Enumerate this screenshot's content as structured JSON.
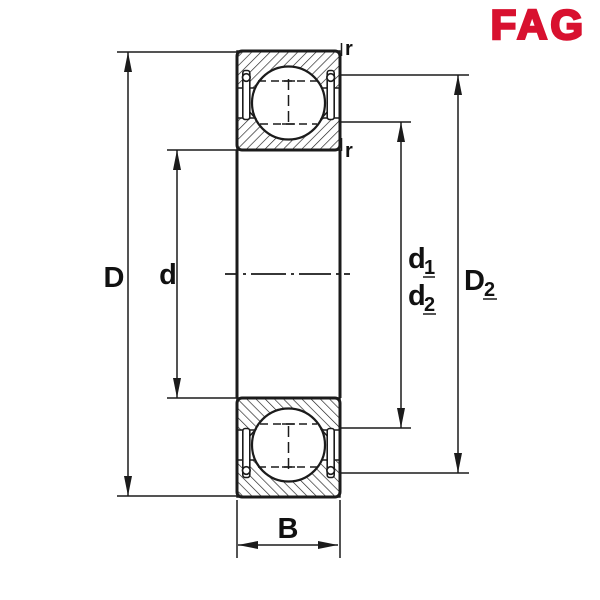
{
  "logo": {
    "text": "FAG",
    "color": "#d8112f"
  },
  "drawing": {
    "ink_color": "#1b1b1b",
    "type": "bearing cross-section dimension drawing",
    "dimensions": {
      "outer_diameter": "D",
      "bore_diameter": "d",
      "shoulder1_base": "d",
      "shoulder1_sub": "1",
      "shoulder2_base": "d",
      "shoulder2_sub": "2",
      "recess_base": "D",
      "recess_sub": "2",
      "width": "B",
      "radius_top": "r",
      "radius_bottom": "r"
    }
  }
}
